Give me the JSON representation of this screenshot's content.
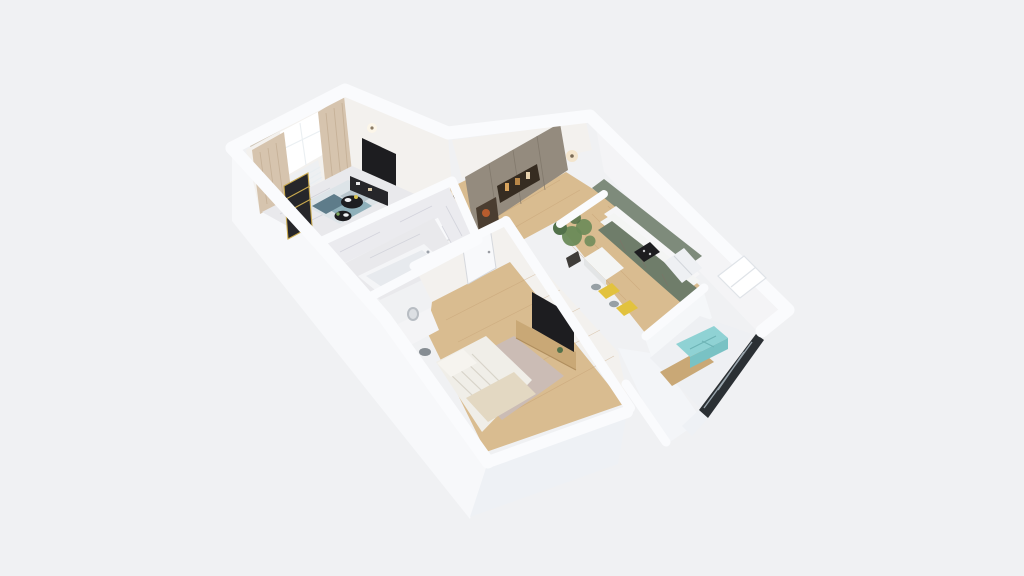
{
  "meta": {
    "kind": "3d-floorplan-dollhouse-render",
    "view": "axonometric top-down cutaway of a one-bedroom apartment",
    "visible_text": "none"
  },
  "palette": {
    "bg": "#f0f1f3",
    "wall_top": "#fafbfd",
    "wall_face_west": "#f7f8fa",
    "wall_face_south": "#eef1f5",
    "wall_inner_warm": "#f3f1ee",
    "wall_inner_cool": "#f4f4f6",
    "marble": "#ebebef",
    "marble_floor": "#e9e9ec",
    "wood": "#d9bc90",
    "wood_dark": "#c9a876",
    "rug_base": "#dde4e8",
    "rug_teal": "#8fb0ba",
    "rug_slate": "#5e7c8a",
    "rug_gray": "#b9c6cd",
    "curtain": "#d6c4ae",
    "window_glow": "#ffffff",
    "dark_screen": "#1d1d20",
    "console_black": "#26262a",
    "gold": "#c9a94e",
    "wardrobe_taupe": "#948b7e",
    "wardrobe_niche": "#362c21",
    "niche_glow": "#d8a35c",
    "kitchen_upper_green": "#7e8b7b",
    "kitchen_lower_green": "#6f7d6a",
    "counter_white": "#f4f5f4",
    "chair_yellow": "#e2c23e",
    "chair_gray": "#97a0a5",
    "plant_green": "#6a8a58",
    "plant_dark": "#52714a",
    "pot_dark": "#3f3c38",
    "fridge_white": "#eef0f3",
    "duvet": "#f0eee8",
    "pillow": "#f6f4ef",
    "throw_cream": "#e3d8c2",
    "bed_rug_mauve": "#cbbcb5",
    "vanity_white": "#f4f4f6",
    "stool_gray": "#868d93",
    "mirror_gray": "#b8bdc3",
    "bench_teal": "#8fd2d4",
    "bench_teal_dark": "#79c2c4",
    "glazing_dark": "#2b3034",
    "door_white": "#f8f9fb",
    "tub_white": "#f4f5f7",
    "sconce_glow": "#f3e3c6"
  },
  "scene": {
    "rooms": [
      {
        "name": "living-room",
        "floor": "marble",
        "furniture": [
          "window",
          "beige-curtains",
          "radiator",
          "gold-shelf",
          "wall-tv",
          "black-console",
          "round-coffee-tables",
          "geometric-rug"
        ]
      },
      {
        "name": "hallway",
        "floor": "wood",
        "furniture": [
          "taupe-wardrobe",
          "lit-niche",
          "wall-sconces",
          "bathroom-door"
        ]
      },
      {
        "name": "bathroom",
        "floor": "marble",
        "furniture": [
          "marble-walls",
          "bathtub"
        ]
      },
      {
        "name": "kitchen",
        "floor": "wood",
        "furniture": [
          "green-upper-cabinets",
          "green-lower-cabinets",
          "white-counter",
          "cooktop",
          "fridge",
          "peninsula",
          "yellow-chairs",
          "tall-plant"
        ]
      },
      {
        "name": "bedroom",
        "floor": "wood",
        "furniture": [
          "bed",
          "pillows",
          "cream-throw",
          "mauve-rug",
          "wall-tv",
          "wood-media-console",
          "vanity-desk",
          "round-mirror",
          "stool",
          "door"
        ]
      },
      {
        "name": "balcony",
        "floor": "mixed",
        "furniture": [
          "teal-bench",
          "dark-glazing"
        ]
      }
    ]
  }
}
